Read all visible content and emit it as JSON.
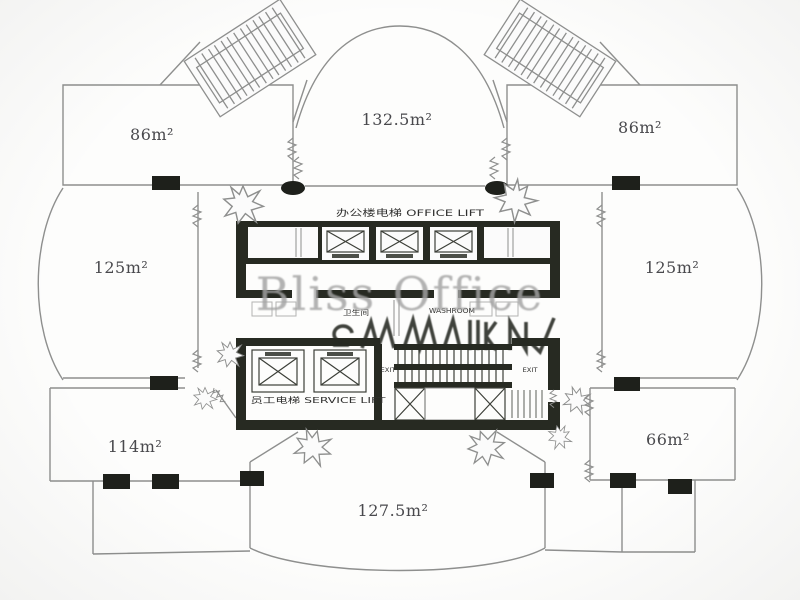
{
  "watermark": {
    "text": "Bliss Office"
  },
  "rooms": [
    {
      "name": "top-left-office",
      "area_label": "86m²"
    },
    {
      "name": "top-center-office",
      "area_label": "132.5m²"
    },
    {
      "name": "top-right-office",
      "area_label": "86m²"
    },
    {
      "name": "left-office",
      "area_label": "125m²"
    },
    {
      "name": "right-office",
      "area_label": "125m²"
    },
    {
      "name": "bottom-left-office",
      "area_label": "114m²"
    },
    {
      "name": "bottom-right-office",
      "area_label": "66m²"
    },
    {
      "name": "bottom-center-office",
      "area_label": "127.5m²"
    }
  ],
  "core": {
    "office_lift_label": "办公楼电梯 OFFICE LIFT",
    "washroom_label_cn": "卫生间",
    "washroom_label_en": "WASHROOM",
    "exit_label_left": "EXIT",
    "exit_label_right": "EXIT",
    "service_lift_label": "员工电梯 SERVICE LIFT"
  },
  "colors": {
    "wall_dark": "#24271f",
    "line_gray": "#8e8f8e",
    "label_gray": "#47474b",
    "watermark_gray": "#a3a3a3",
    "paper": "#fdfdfc"
  }
}
